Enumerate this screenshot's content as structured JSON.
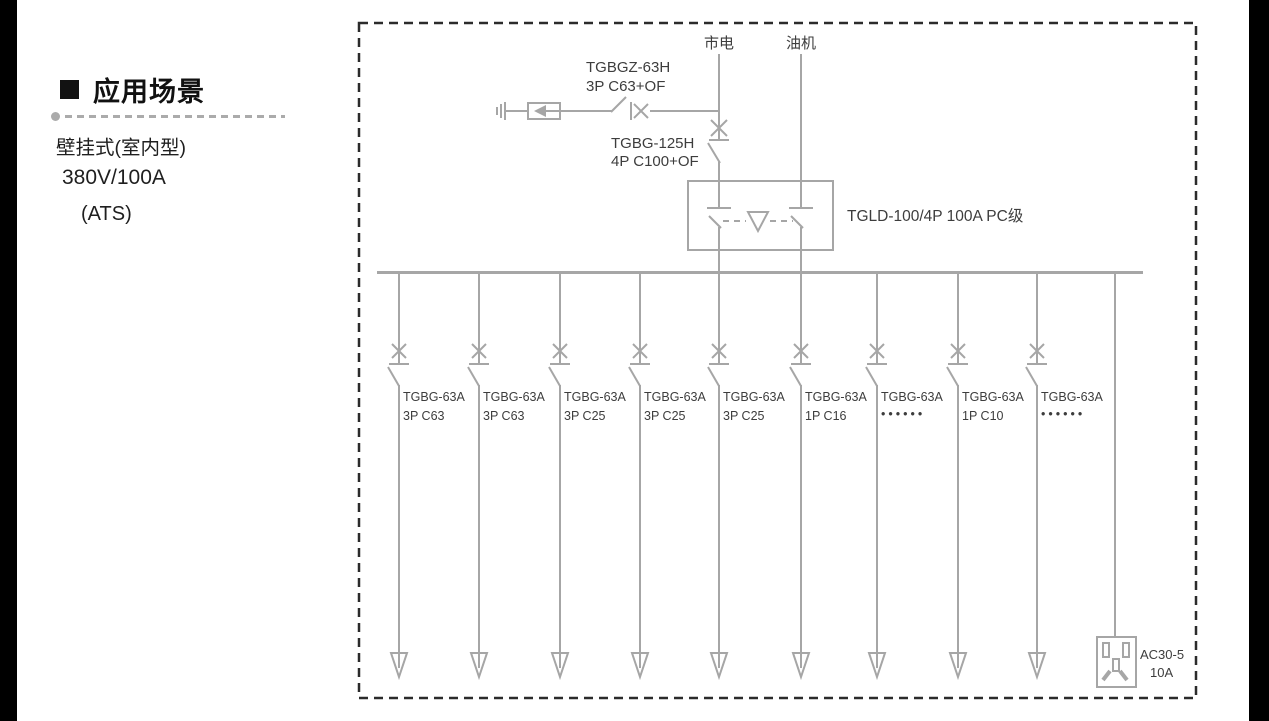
{
  "left_panel": {
    "title": "应用场景",
    "line1": "壁挂式(室内型)",
    "line2": "380V/100A",
    "line3": "(ATS)"
  },
  "diagram": {
    "mains_label": "市电",
    "generator_label": "油机",
    "spd_breaker_model": "TGBGZ-63H",
    "spd_breaker_spec": "3P C63+OF",
    "main_breaker_model": "TGBG-125H",
    "main_breaker_spec": "4P C100+OF",
    "ats_label": "TGLD-100/4P 100A PC级",
    "branches": [
      {
        "model": "TGBG-63A",
        "spec": "3P C63"
      },
      {
        "model": "TGBG-63A",
        "spec": "3P C63"
      },
      {
        "model": "TGBG-63A",
        "spec": "3P C25"
      },
      {
        "model": "TGBG-63A",
        "spec": "3P C25"
      },
      {
        "model": "TGBG-63A",
        "spec": "3P C25"
      },
      {
        "model": "TGBG-63A",
        "spec": "1P C16"
      },
      {
        "model": "TGBG-63A",
        "spec": "••••••"
      },
      {
        "model": "TGBG-63A",
        "spec": "1P C10"
      },
      {
        "model": "TGBG-63A",
        "spec": "••••••"
      }
    ],
    "socket_model": "AC30-5",
    "socket_rating": "10A"
  },
  "colors": {
    "line_gray": "#a6a6a6",
    "diagram_text": "#3d3d3d",
    "border_dark": "#2b2b2b",
    "divider_gray": "#ababab",
    "edge_bar_black": "#000000"
  }
}
